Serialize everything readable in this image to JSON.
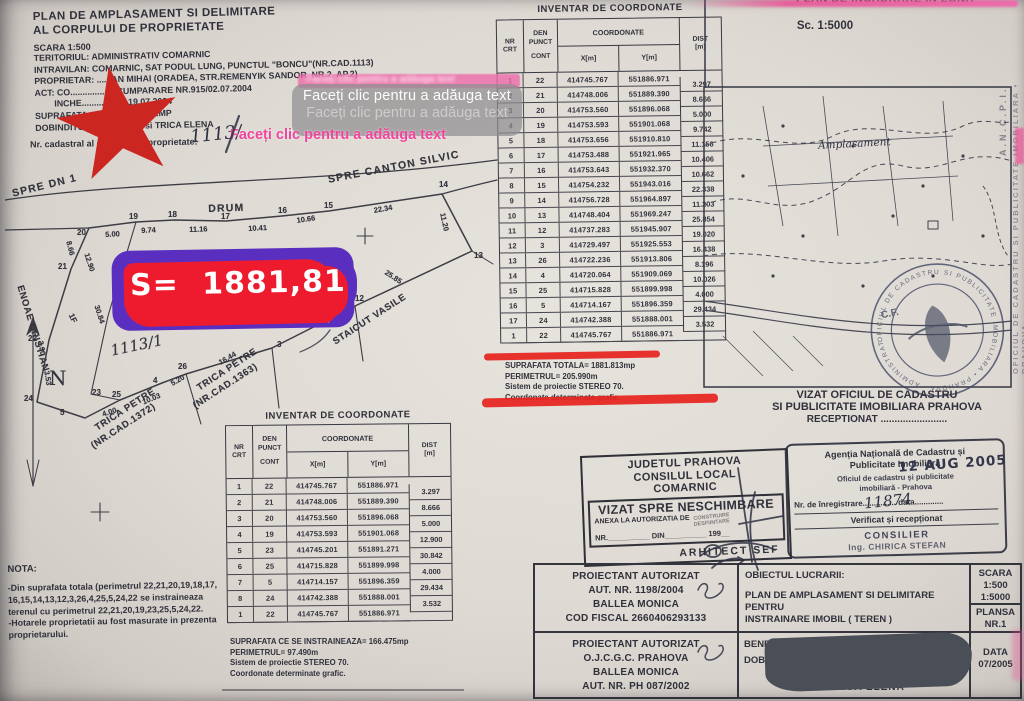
{
  "header": {
    "title_line1": "PLAN DE AMPLASAMENT SI DELIMITARE",
    "title_line2": "AL CORPULUI DE PROPRIETATE",
    "scara": "SCARA 1:500",
    "info_lines": [
      "TERITORIUL: ADMINISTRATIV COMARNIC",
      "INTRAVILAN: COMARNIC, SAT PODUL LUNG, PUNCTUL \"BONCU\"(NR.CAD.1113)",
      "PROPRIETAR: ......AN MIHAI (ORADEA, STR.REMENYIK SANDOR, NR.2, AP.2)",
      "ACT: CO.................. CUMPARARE NR.915/02.07.2004",
      "        INCHE.................. 19.07.2004",
      "SUPRAFATA ..................: 1882MP",
      "DOBINDITOR: ..............RE si TRICA ELENA"
    ],
    "cadastral_label": "Nr. cadastral al corpului de proprietate:",
    "cadastral_value": "1113/"
  },
  "overlay": {
    "placeholder_primary": "Faceți clic pentru a adăuga text",
    "placeholder_secondary": "Faceți clic pentru a adăuga text",
    "placeholder_pink": "Faceți clic pentru a adăuga text",
    "placeholder_strip": "Faceți clic pentru a adăuga text",
    "area_text": "S= 1881,81",
    "colors": {
      "purple": "#5a2fc0",
      "red": "#ee1b2e",
      "pink": "#f0459c",
      "star_red": "#cb2620",
      "orange": "#f2a43b"
    }
  },
  "drawing": {
    "labels": [
      {
        "t": "SPRE DN 1",
        "x": 6,
        "y": 32,
        "r": -14,
        "c": "road"
      },
      {
        "t": "DRUM",
        "x": 203,
        "y": 47,
        "r": -2,
        "c": "road"
      },
      {
        "t": "SPRE CANTON SILVIC",
        "x": 322,
        "y": 18,
        "r": -11,
        "c": "road"
      },
      {
        "t": "20",
        "x": 72,
        "y": 72,
        "c": "pt"
      },
      {
        "t": "19",
        "x": 124,
        "y": 56,
        "c": "pt"
      },
      {
        "t": "18",
        "x": 163,
        "y": 54,
        "c": "pt"
      },
      {
        "t": "17",
        "x": 216,
        "y": 56,
        "c": "pt"
      },
      {
        "t": "16",
        "x": 273,
        "y": 50,
        "c": "pt"
      },
      {
        "t": "15",
        "x": 319,
        "y": 45,
        "c": "pt"
      },
      {
        "t": "14",
        "x": 434,
        "y": 24,
        "c": "pt"
      },
      {
        "t": "13",
        "x": 469,
        "y": 95,
        "c": "pt"
      },
      {
        "t": "12",
        "x": 350,
        "y": 138,
        "c": "pt"
      },
      {
        "t": "3",
        "x": 272,
        "y": 184,
        "c": "pt"
      },
      {
        "t": "26",
        "x": 173,
        "y": 206,
        "c": "pt"
      },
      {
        "t": "4",
        "x": 148,
        "y": 220,
        "c": "pt"
      },
      {
        "t": "25",
        "x": 107,
        "y": 234,
        "c": "pt"
      },
      {
        "t": "5",
        "x": 55,
        "y": 252,
        "c": "pt"
      },
      {
        "t": "24",
        "x": 19,
        "y": 238,
        "c": "pt"
      },
      {
        "t": "23",
        "x": 87,
        "y": 232,
        "c": "pt"
      },
      {
        "t": "22",
        "x": 23,
        "y": 178,
        "c": "pt"
      },
      {
        "t": "21",
        "x": 53,
        "y": 106,
        "c": "pt"
      },
      {
        "t": "1F",
        "x": 70,
        "y": 156,
        "r": 65,
        "c": "pt"
      },
      {
        "t": "5.00",
        "x": 100,
        "y": 74,
        "r": -3,
        "c": "dist"
      },
      {
        "t": "9.74",
        "x": 136,
        "y": 70,
        "r": -3,
        "c": "dist"
      },
      {
        "t": "11.16",
        "x": 184,
        "y": 69,
        "r": -2,
        "c": "dist"
      },
      {
        "t": "10.41",
        "x": 243,
        "y": 68,
        "r": -3,
        "c": "dist"
      },
      {
        "t": "10.66",
        "x": 291,
        "y": 60,
        "r": -8,
        "c": "dist"
      },
      {
        "t": "22.34",
        "x": 368,
        "y": 50,
        "r": -10,
        "c": "dist"
      },
      {
        "t": "11.20",
        "x": 442,
        "y": 56,
        "r": 78,
        "c": "dist"
      },
      {
        "t": "25.85",
        "x": 383,
        "y": 112,
        "r": 33,
        "c": "dist"
      },
      {
        "t": "19.02",
        "x": 296,
        "y": 164,
        "r": -30,
        "c": "dist"
      },
      {
        "t": "16.44",
        "x": 212,
        "y": 203,
        "r": -30,
        "c": "dist"
      },
      {
        "t": "5.20",
        "x": 164,
        "y": 224,
        "r": -30,
        "c": "dist"
      },
      {
        "t": "10.03",
        "x": 136,
        "y": 242,
        "r": -22,
        "c": "dist"
      },
      {
        "t": "4.00",
        "x": 96,
        "y": 254,
        "r": -18,
        "c": "dist"
      },
      {
        "t": "12.90",
        "x": 86,
        "y": 96,
        "r": 72,
        "c": "dist"
      },
      {
        "t": "8.66",
        "x": 68,
        "y": 84,
        "r": 75,
        "c": "dist"
      },
      {
        "t": "30.84",
        "x": 96,
        "y": 148,
        "r": 72,
        "c": "dist"
      },
      {
        "t": "3.30",
        "x": 40,
        "y": 184,
        "r": 80,
        "c": "dist"
      },
      {
        "t": "3.53",
        "x": 46,
        "y": 214,
        "r": 80,
        "c": "dist"
      },
      {
        "t": "ENOAE CRISTIAN",
        "x": 20,
        "y": 128,
        "r": 73,
        "c": "name"
      },
      {
        "t": "TRICA PETRE",
        "x": 88,
        "y": 268,
        "r": -33,
        "c": "name"
      },
      {
        "t": "(NR.CAD.1372)",
        "x": 84,
        "y": 286,
        "r": -33,
        "c": "name"
      },
      {
        "t": "TRICA PETRE",
        "x": 190,
        "y": 228,
        "r": -33,
        "c": "name"
      },
      {
        "t": "(NR.CAD.1363)",
        "x": 186,
        "y": 246,
        "r": -33,
        "c": "name"
      },
      {
        "t": "STAICUT VASILE",
        "x": 326,
        "y": 182,
        "r": -33,
        "c": "name"
      },
      {
        "t": "1113/1",
        "x": 104,
        "y": 186,
        "r": -12,
        "c": "hw"
      },
      {
        "t": "N",
        "x": 44,
        "y": 210,
        "c": "compass"
      }
    ]
  },
  "tables": {
    "head": {
      "nr": "NR",
      "crt": "CRT",
      "den": "DEN",
      "punct": "PUNCT",
      "cont": "CONT",
      "coord": "COORDONATE",
      "x": "X[m]",
      "y": "Y[m]",
      "dist": "DIST",
      "m": "[m]"
    },
    "main": {
      "title": "INVENTAR DE COORDONATE",
      "rows": [
        [
          "1",
          "22",
          "414745.767",
          "551886.971"
        ],
        [
          "2",
          "21",
          "414748.006",
          "551889.390"
        ],
        [
          "3",
          "20",
          "414753.560",
          "551896.068"
        ],
        [
          "4",
          "19",
          "414753.593",
          "551901.068"
        ],
        [
          "5",
          "18",
          "414753.656",
          "551910.810"
        ],
        [
          "6",
          "17",
          "414753.488",
          "551921.965"
        ],
        [
          "7",
          "16",
          "414753.643",
          "551932.370"
        ],
        [
          "8",
          "15",
          "414754.232",
          "551943.016"
        ],
        [
          "9",
          "14",
          "414756.728",
          "551964.897"
        ],
        [
          "10",
          "13",
          "414748.404",
          "551969.247"
        ],
        [
          "11",
          "12",
          "414737.283",
          "551945.907"
        ],
        [
          "12",
          "3",
          "414729.497",
          "551925.553"
        ],
        [
          "13",
          "26",
          "414722.236",
          "551913.806"
        ],
        [
          "14",
          "4",
          "414720.064",
          "551909.069"
        ],
        [
          "15",
          "25",
          "414715.828",
          "551899.998"
        ],
        [
          "16",
          "5",
          "414714.167",
          "551896.359"
        ],
        [
          "17",
          "24",
          "414742.388",
          "551888.001"
        ],
        [
          "1",
          "22",
          "414745.767",
          "551886.971"
        ]
      ],
      "dists": [
        "3.297",
        "8.666",
        "5.000",
        "9.742",
        "11.156",
        "10.406",
        "10.662",
        "22.338",
        "11.203",
        "25.854",
        "19.020",
        "16.438",
        "8.196",
        "10.026",
        "4.000",
        "29.434",
        "3.532"
      ],
      "summary": [
        "SUPRAFATA TOTALA= 1881.813mp",
        "PERIMETRUL= 205.990m",
        "Sistem de proiectie STEREO 70.",
        "Coordonate determinate grafic."
      ]
    },
    "second": {
      "title": "INVENTAR DE COORDONATE",
      "rows": [
        [
          "1",
          "22",
          "414745.767",
          "551886.971"
        ],
        [
          "2",
          "21",
          "414748.006",
          "551889.390"
        ],
        [
          "3",
          "20",
          "414753.560",
          "551896.068"
        ],
        [
          "4",
          "19",
          "414753.593",
          "551901.068"
        ],
        [
          "5",
          "23",
          "414745.201",
          "551891.271"
        ],
        [
          "6",
          "25",
          "414715.828",
          "551899.998"
        ],
        [
          "7",
          "5",
          "414714.157",
          "551896.359"
        ],
        [
          "8",
          "24",
          "414742.388",
          "551888.001"
        ],
        [
          "1",
          "22",
          "414745.767",
          "551886.971"
        ]
      ],
      "dists": [
        "3.297",
        "8.666",
        "5.000",
        "12.900",
        "30.842",
        "4.000",
        "29.434",
        "3.532"
      ],
      "summary": [
        "SUPRAFATA CE SE INSTRAINEAZA= 166.475mp",
        "PERIMETRUL= 97.490m",
        "Sistem de proiectie STEREO 70.",
        "Coordonate determinate grafic."
      ]
    }
  },
  "nota": {
    "title": "NOTA:",
    "lines": [
      "-Din suprafata totala (perimetrul 22,21,20,19,18,17,",
      "16,15,14,13,12,3,26,4,25,5,24,22 se instraineaza",
      "terenul cu perimetrul 22,21,20,19,23,25,5,24,22.",
      "-Hotarele proprietatii au fost masurate in prezenta",
      "proprietarului."
    ]
  },
  "map": {
    "title": "PLAN DE INCADRARE IN ZONA",
    "scale": "Sc. 1:5000",
    "handwritten_label": "Amplasament",
    "side_text_top": "A.N.C.P.I.",
    "side_text_main": "OFICIUL DE CADASTRU SI PUBLICITATE IMOBILIARA • PRAHOVA",
    "stamp_ring_text": "OFICIUL DE CADASTRU SI PUBLICITATE IMOBILIARA • PRAHOVA • ADMINISTRATIEI •",
    "stamp_cf": "C.F."
  },
  "vizat": {
    "line1": "VIZAT  OFICIUL DE CADASTRU",
    "line2": "SI PUBLICITATE IMOBILIARA PRAHOVA",
    "line3": "RECEPTIONAT ........................"
  },
  "registration": {
    "agency_line1": "Agenția Națională de Cadastru și",
    "agency_line2": "Publicitate Imobiliară",
    "office_line1": "Oficiul de cadastru și publicitate",
    "office_line2": "imobiliară - Prahova",
    "nr_line": "Nr. de înregistrare............... data.............",
    "nr_handwritten": "11874",
    "date_stamp": "12 AUG 2005",
    "verified": "Verificat și recepționat",
    "consilier": "CONSILIER",
    "consilier_name": "Ing. CHIRICA STEFAN"
  },
  "council": {
    "line1": "JUDETUL PRAHOVA",
    "line2": "CONSILUL LOCAL",
    "line3": "COMARNIC",
    "vizat": "VIZAT SPRE NESCHIMBARE",
    "anexa": "ANEXA LA AUTORIZATIA DE",
    "anexa_opt1": "CONSTRUIRE",
    "anexa_opt2": "DESFIINTARE",
    "nr_line": "NR.__________ DIN__________ 199__",
    "arhitect": "ARHITECT SEF"
  },
  "footer": {
    "proiectant1": [
      "PROIECTANT AUTORIZAT",
      "AUT. NR. 1198/2004",
      "BALLEA MONICA",
      "COD FISCAL 2660406293133"
    ],
    "proiectant2": [
      "PROIECTANT AUTORIZAT",
      "O.J.C.G.C. PRAHOVA",
      "BALLEA MONICA",
      "AUT. NR. PH 087/2002"
    ],
    "obiect_label": "OBIECTUL LUCRARII:",
    "obiect_lines": [
      "PLAN DE AMPLASAMENT SI DELIMITARE PENTRU",
      "INSTRAINARE IMOBIL ( TEREN )"
    ],
    "scara_label": "SCARA",
    "scara_values": [
      "1:500",
      "1:5000"
    ],
    "plansa_label": "PLANSA",
    "plansa_value": "NR.1",
    "beneficiar_label": "BENEFIC",
    "beneficiar_label2": "DOB",
    "beneficiar_name": "TRICA ELENA",
    "data_label": "DATA",
    "data_value": "07/2005"
  }
}
